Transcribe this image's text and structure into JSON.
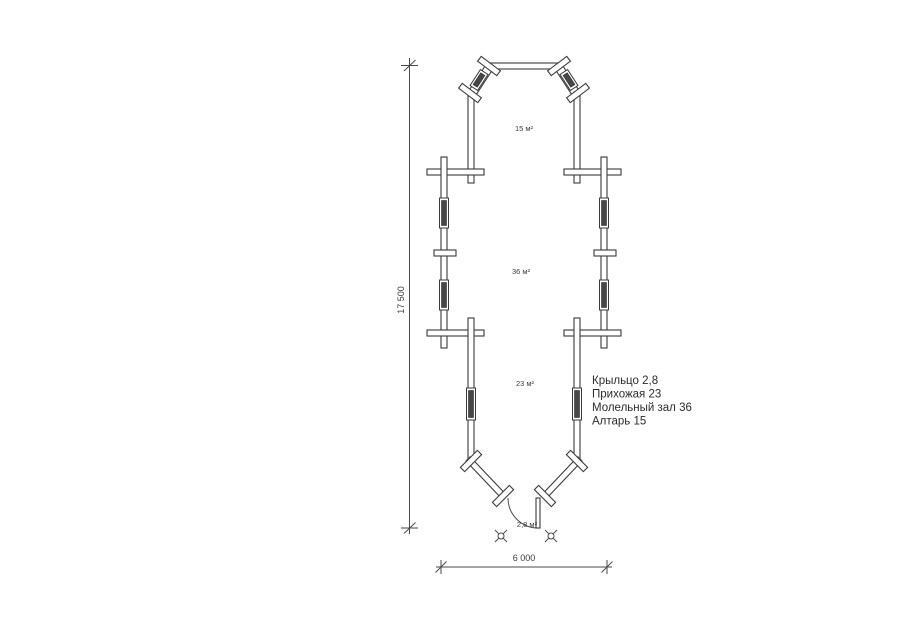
{
  "drawing": {
    "kind": "floor-plan",
    "colors": {
      "line": "#3a3a3a",
      "background": "#ffffff",
      "window_fill": "#474747"
    }
  },
  "areas": {
    "altar": "15 м²",
    "prayer_hall": "36 м²",
    "entry_hall": "23 м²",
    "porch": "2,8 м²"
  },
  "dimensions": {
    "overall_length": "17 500",
    "overall_width": "6 000"
  },
  "legend": {
    "lines": [
      "Крыльцо 2,8",
      "Прихожая 23",
      "Молельный зал 36",
      "Алтарь 15"
    ]
  }
}
